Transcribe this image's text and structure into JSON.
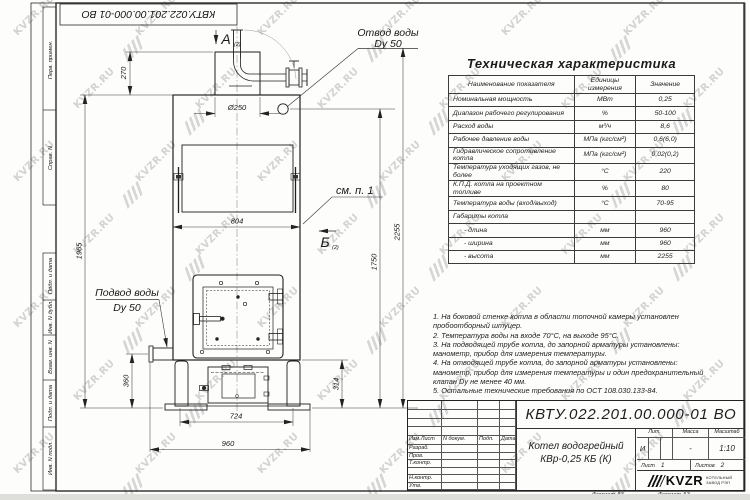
{
  "frame": {
    "top_stamp": "КВТУ.022.201.00.000-01 ВО",
    "left_fields_top": [
      "Перв. примен.",
      "Справ. N"
    ],
    "left_fields_bottom": [
      "Подп. и дата",
      "Инв. N дубл.",
      "Взам. инв. N",
      "Подп. и дата",
      "Инв. N подл."
    ],
    "format_label_1": "Формат А3",
    "format_label_2": "Формат А3"
  },
  "spec_table": {
    "title": "Техническая характеристика",
    "columns": [
      "Наименование показателя",
      "Единицы измерения",
      "Значение"
    ],
    "rows": [
      [
        "Номинальная мощность",
        "МВт",
        "0,25"
      ],
      [
        "Диапазон рабочего регулирования",
        "%",
        "50-100"
      ],
      [
        "Расход воды",
        "м³/ч",
        "8,6"
      ],
      [
        "Рабочее давление воды",
        "МПа (кгс/см²)",
        "0,6(6,0)"
      ],
      [
        "Гидравлическое сопротивление котла",
        "МПа (кгс/см²)",
        "0,02(0,2)"
      ],
      [
        "Температура уходящих газов, не более",
        "°С",
        "220"
      ],
      [
        "К.П.Д. котла на проектном топливе",
        "%",
        "80"
      ],
      [
        "Температура воды (вход/выход)",
        "°С",
        "70-95"
      ],
      [
        "Габариты котла",
        "",
        ""
      ],
      [
        "- длина",
        "мм",
        "960"
      ],
      [
        "- ширина",
        "мм",
        "960"
      ],
      [
        "- высота",
        "мм",
        "2255"
      ]
    ]
  },
  "notes": [
    "1. На боковой стенке котла в области топочной камеры установлен пробоотборный штуцер.",
    "2. Температура воды на входе 70°С, на выходе 95°С.",
    "3. На подводящей трубе котла, до запорной арматуры установлены: манометр, прибор для измерения температуры.",
    "4. На отводящей трубе котла, до запорной арматуры установлены: манометр, прибор для измерения температуры и один предохранительный клапан Dу не менее 40 мм.",
    "5. Остальные технические требования по ОСТ 108.030.133-84."
  ],
  "title_block": {
    "designation": "КВТУ.022.201.00.000-01 ВО",
    "name_line1": "Котел водогрейный",
    "name_line2": "КВр-0,25 КБ (К)",
    "header_cols": [
      "Изм.Лист",
      "N докум.",
      "Подп.",
      "Дата"
    ],
    "row_labels": [
      "Разраб.",
      "Пров.",
      "Т.контр.",
      "",
      "Н.контр.",
      "Утв."
    ],
    "lit_label": "Лит.",
    "mass_label": "Масса",
    "scale_label": "Масштаб",
    "lit_value": "И",
    "mass_value": "-",
    "scale_value": "1:10",
    "sheet_label": "Лист",
    "sheet_value": "1",
    "sheets_label": "Листов",
    "sheets_value": "2",
    "company": "KVZR",
    "company_sub1": "КОТЕЛЬНЫЙ",
    "company_sub2": "ЗАВОД РЭП"
  },
  "drawing": {
    "labels": {
      "view_a": "А",
      "view_a_sub": "(2)",
      "view_b": "Б",
      "view_b_sub": "(2)",
      "see_note": "см. п. 1",
      "outlet_line1": "Отвод воды",
      "outlet_line2": "Dy 50",
      "inlet_line1": "Подвод воды",
      "inlet_line2": "Dy 50"
    },
    "dims": {
      "d270": "270",
      "d1965": "1965",
      "d250": "Ø250",
      "d804": "804",
      "d2255": "2255",
      "d1750": "1750",
      "d360": "360",
      "d314": "314",
      "d724": "724",
      "d960": "960"
    }
  },
  "watermark": {
    "text": "KVZR.RU"
  }
}
